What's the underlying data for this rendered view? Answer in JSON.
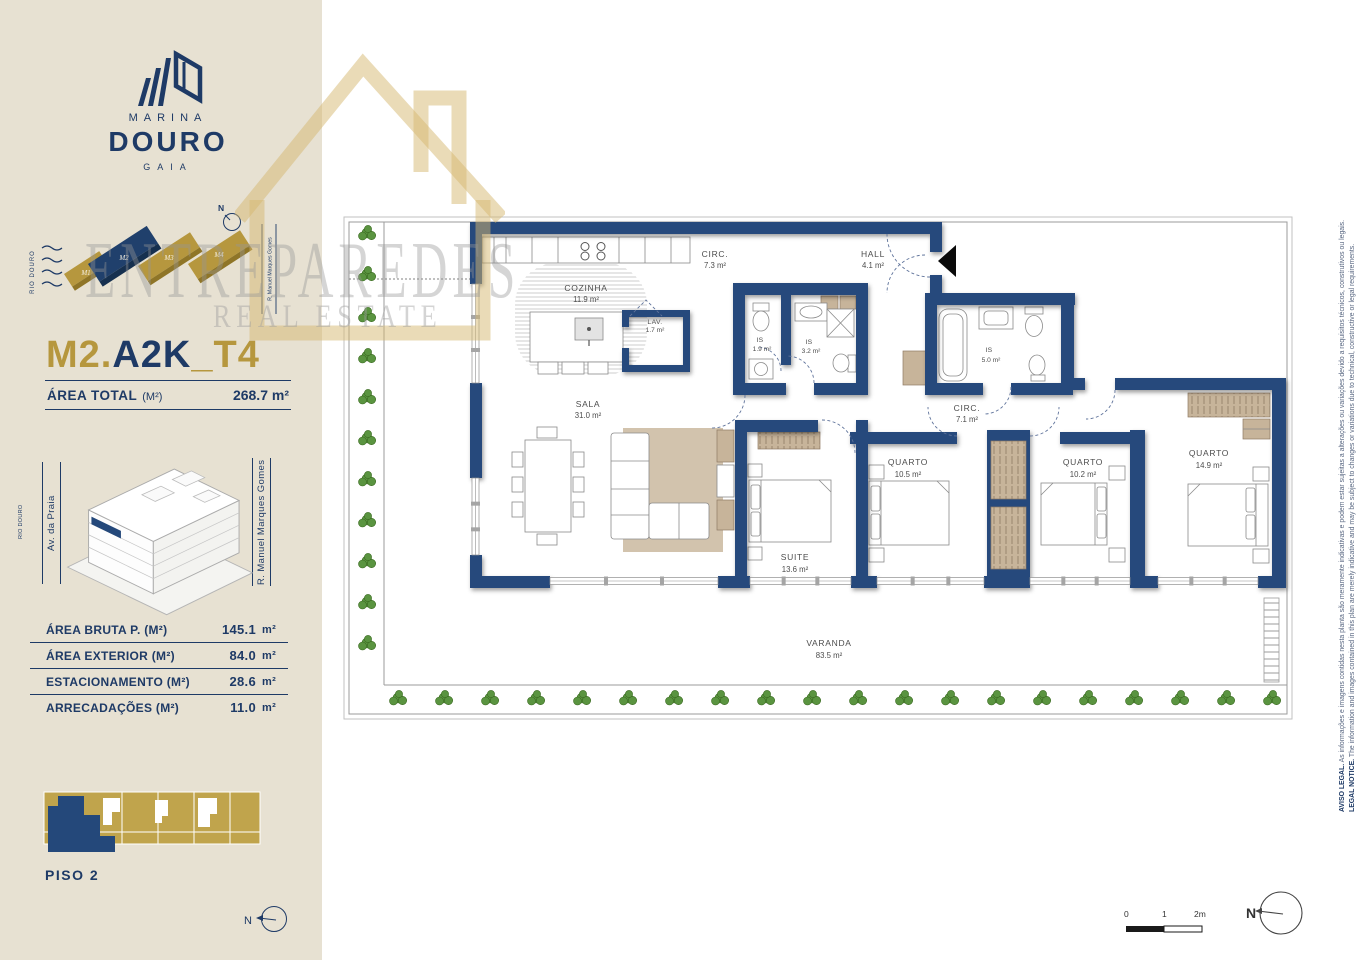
{
  "brand": {
    "marina": "MARINA",
    "douro": "DOURO",
    "gaia": "GAIA"
  },
  "sitemap": {
    "river": "RIO DOURO",
    "north": "N",
    "street": "R. Manuel Marques Gomes",
    "blocks": [
      "M1",
      "M2",
      "M3",
      "M4"
    ]
  },
  "unit": {
    "code_prefix": "M2.",
    "code_mid": "A2K",
    "code_suffix": "_T4",
    "area_total_label": "ÁREA TOTAL",
    "area_total_unit": "(M²)",
    "area_total_value": "268.7 m²"
  },
  "building": {
    "street_left": "Av. da Praia",
    "street_right": "R. Manuel Marques Gomes",
    "river": "RIO DOURO"
  },
  "areas": [
    {
      "label": "ÁREA BRUTA P.  (M²)",
      "value": "145.1",
      "unit": "m²"
    },
    {
      "label": "ÁREA EXTERIOR (M²)",
      "value": "84.0",
      "unit": "m²"
    },
    {
      "label": "ESTACIONAMENTO (M²)",
      "value": "28.6",
      "unit": "m²"
    },
    {
      "label": "ARRECADAÇÕES (M²)",
      "value": "11.0",
      "unit": "m²"
    }
  ],
  "floor": {
    "label": "PISO 2",
    "north": "N"
  },
  "watermark": {
    "line1": "ENTREPAREDES",
    "line2": "REAL ESTATE"
  },
  "plan": {
    "rooms": [
      {
        "name": "COZINHA",
        "area": "11.9 m²"
      },
      {
        "name": "SALA",
        "area": "31.0 m²"
      },
      {
        "name": "LAV.",
        "area": "1.7 m²"
      },
      {
        "name": "CIRC.",
        "area": "7.3 m²"
      },
      {
        "name": "HALL",
        "area": "4.1 m²"
      },
      {
        "name": "IS",
        "area": "1.9 m²"
      },
      {
        "name": "IS",
        "area": "3.2 m²"
      },
      {
        "name": "IS",
        "area": "5.0 m²"
      },
      {
        "name": "CIRC.",
        "area": "7.1 m²"
      },
      {
        "name": "SUITE",
        "area": "13.6 m²"
      },
      {
        "name": "QUARTO",
        "area": "10.5 m²"
      },
      {
        "name": "QUARTO",
        "area": "10.2 m²"
      },
      {
        "name": "QUARTO",
        "area": "14.9 m²"
      },
      {
        "name": "VARANDA",
        "area": "83.5 m²"
      }
    ]
  },
  "legal": {
    "pt_bold": "AVISO LEGAL.",
    "pt_text": " As informações e imagens contidas nesta planta são meramente indicativas e podem estar sujeitas a alterações ou variações devido a requisitos técnicos, construtivos ou legais.",
    "en_bold": "LEGAL NOTICE.",
    "en_text": " The information and images contained in this plan are merely indicative and may be subject to changes or variations due to technical, constructive or legal requirements."
  },
  "scale": {
    "t0": "0",
    "t1": "1",
    "t2": "2m"
  },
  "compass": {
    "label": "N"
  }
}
